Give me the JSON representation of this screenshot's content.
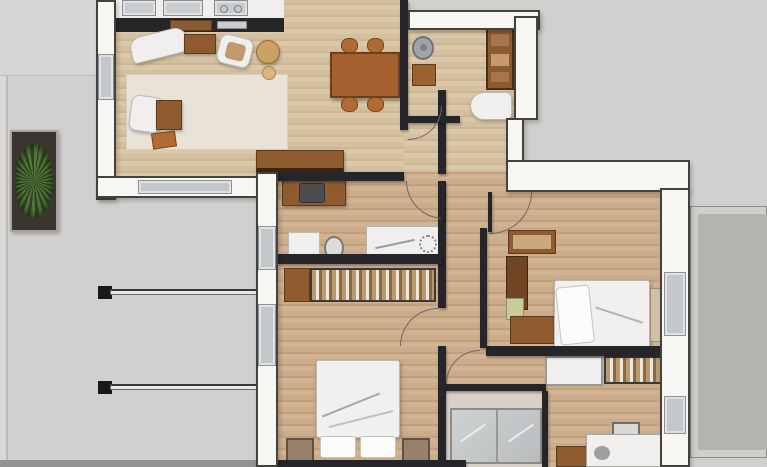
{
  "scene": {
    "type": "3d-rendered-apartment-floor-plan-top-view",
    "visible_text": [],
    "rooms": [
      "living-room-with-kitchen",
      "dining-area",
      "entry-bathroom",
      "home-office",
      "bedroom",
      "master-bedroom",
      "shower-bathroom",
      "study-room",
      "terrace-left",
      "terrace-right"
    ],
    "furniture": [
      "kitchen-counter",
      "sink-tile",
      "stove-tile",
      "chaise-lounge",
      "coffee-table",
      "armchair",
      "pouf",
      "rug",
      "sideboard",
      "dining-table",
      "dining-chair",
      "round-sink",
      "toilet",
      "shelf-cabinet",
      "printer-cabinet",
      "writing-desk",
      "mirror",
      "wardrobe",
      "double-bed",
      "nightstand",
      "dresser",
      "bed-bench",
      "shower-enclosure",
      "office-desk",
      "office-chair",
      "storage-box",
      "planter-plant",
      "balcony-railing"
    ]
  },
  "palette": {
    "ground": "#d2d0ce",
    "ground-light": "#dbd9d7",
    "terrace": "#b5b3b0",
    "terrace-frame": "#d0cecb",
    "wall-fill": "#f7f6f3",
    "wall-edge": "#44423f",
    "interior-wall": "#26262a",
    "wood1": "#dac8ab",
    "wood1b": "#ccb692",
    "wood1c": "#d4c09f",
    "wood2": "#d1b293",
    "wood2b": "#c1a07c",
    "wood2c": "#cbac8a",
    "glass": "#c3c7c9",
    "rug": "#e9e3d7",
    "white-furn": "#f0efed",
    "furn-edge": "#bcbab7",
    "wood-furn": "#8f5a2e",
    "wood-furn-dark": "#5e3a1c",
    "wood-furn-light": "#b06a33",
    "appliance": "#c9ccce",
    "metal": "#9fa4a8",
    "bedding": "#f1f0ee",
    "plant": "#55773c",
    "plant-dark": "#2c441f",
    "railing": "#ebe9e7",
    "post": "#181818",
    "tile-floor": "#d6d0c6",
    "arc": "#6a6866",
    "dark-strip": "#949290",
    "accent-green": "#c9cc9a",
    "bench-tan": "#d0c2a6"
  }
}
